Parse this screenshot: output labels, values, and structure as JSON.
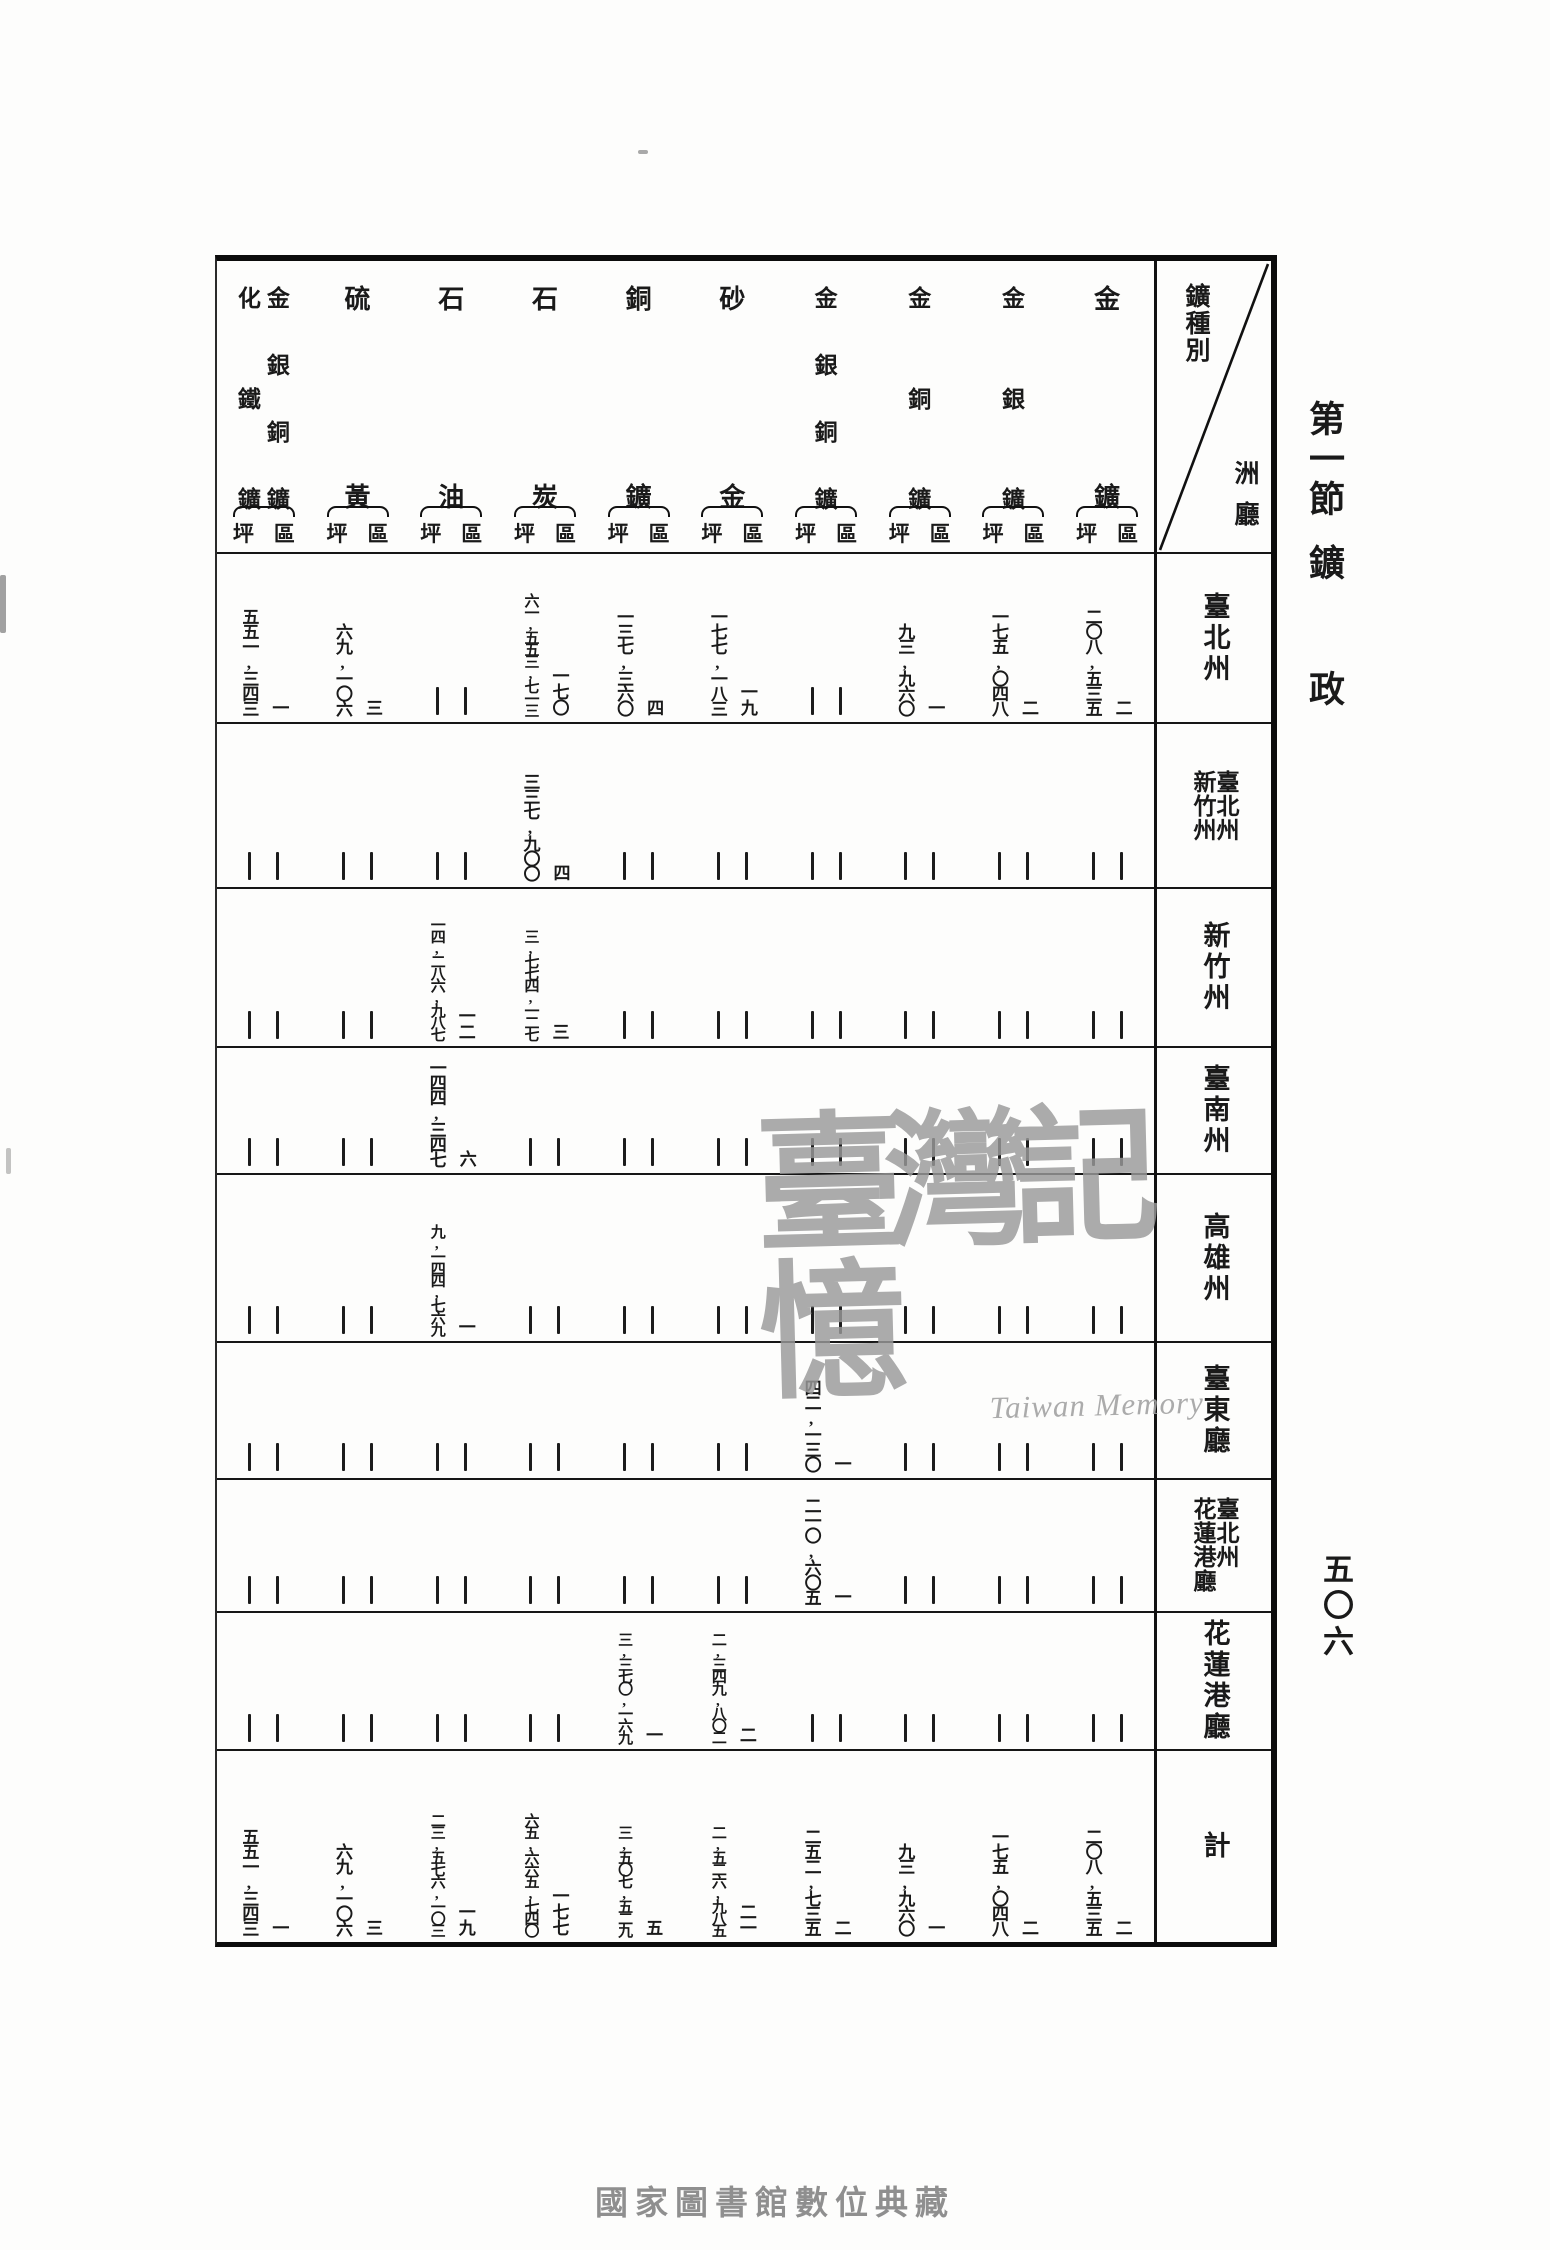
{
  "page": {
    "section_title_part1": "第一節",
    "section_title_part2": "鑛",
    "section_title_part3": "政",
    "page_number": "五〇六",
    "watermark_title": "臺灣記憶",
    "watermark_subtitle": "Taiwan Memory",
    "footer_watermark": "國家圖書館數位典藏"
  },
  "table": {
    "corner": {
      "top_label": "鑛種別",
      "bottom_label": "洲廳"
    },
    "unit_area": "坪",
    "unit_count": "區",
    "columns": [
      {
        "name_lines": [
          "金鑛"
        ]
      },
      {
        "name_lines": [
          "金銀鑛"
        ]
      },
      {
        "name_lines": [
          "金銅鑛"
        ]
      },
      {
        "name_lines": [
          "金銀銅鑛"
        ]
      },
      {
        "name_lines": [
          "砂金"
        ]
      },
      {
        "name_lines": [
          "銅鑛"
        ]
      },
      {
        "name_lines": [
          "石炭"
        ]
      },
      {
        "name_lines": [
          "石油"
        ]
      },
      {
        "name_lines": [
          "硫黃"
        ]
      },
      {
        "name_lines": [
          "金銀銅鑛",
          "化鐵鑛"
        ]
      }
    ],
    "rows": [
      {
        "label_lines": [
          "臺北州"
        ],
        "cells": [
          {
            "ku": "二",
            "tsubo": "二〇八,五三五"
          },
          {
            "ku": "二",
            "tsubo": "一七五,〇四八"
          },
          {
            "ku": "一",
            "tsubo": "九三,九六〇"
          },
          null,
          {
            "ku": "一九",
            "tsubo": "一七七,一八三"
          },
          {
            "ku": "四",
            "tsubo": "一三七,三六〇"
          },
          {
            "ku": "一七〇",
            "tsubo": "六一,五五三,七一三"
          },
          null,
          {
            "ku": "三",
            "tsubo": "六九,一〇六"
          },
          {
            "ku": "一",
            "tsubo": "五五一,三四三"
          }
        ]
      },
      {
        "label_lines": [
          "臺北州",
          "新竹州"
        ],
        "cells": [
          null,
          null,
          null,
          null,
          null,
          null,
          {
            "ku": "四",
            "tsubo": "三三七,九〇〇"
          },
          null,
          null,
          null
        ]
      },
      {
        "label_lines": [
          "新竹州"
        ],
        "cells": [
          null,
          null,
          null,
          null,
          null,
          null,
          {
            "ku": "三",
            "tsubo": "三,七七四,一二七"
          },
          {
            "ku": "一二",
            "tsubo": "一四,二八六,九八七"
          },
          null,
          null
        ]
      },
      {
        "label_lines": [
          "臺南州"
        ],
        "cells": [
          null,
          null,
          null,
          null,
          null,
          null,
          null,
          {
            "ku": "六",
            "tsubo": "一四四,三四七"
          },
          null,
          null
        ]
      },
      {
        "label_lines": [
          "高雄州"
        ],
        "cells": [
          null,
          null,
          null,
          null,
          null,
          null,
          null,
          {
            "ku": "一",
            "tsubo": "九,一四四,七六九"
          },
          null,
          null
        ]
      },
      {
        "label_lines": [
          "臺東廳"
        ],
        "cells": [
          null,
          null,
          null,
          {
            "ku": "一",
            "tsubo": "四二,一三〇"
          },
          null,
          null,
          null,
          null,
          null,
          null
        ]
      },
      {
        "label_lines": [
          "臺北州",
          "花蓮港廳"
        ],
        "cells": [
          null,
          null,
          null,
          {
            "ku": "一",
            "tsubo": "二一〇,六〇五"
          },
          null,
          null,
          null,
          null,
          null,
          null
        ]
      },
      {
        "label_lines": [
          "花蓮港廳"
        ],
        "cells": [
          null,
          null,
          null,
          null,
          {
            "ku": "二",
            "tsubo": "二,三四九,八〇二"
          },
          {
            "ku": "一",
            "tsubo": "三,三七〇,一六九"
          },
          null,
          null,
          null,
          null
        ]
      },
      {
        "label_lines": [
          "計"
        ],
        "cells": [
          {
            "ku": "二",
            "tsubo": "二〇八,五三五"
          },
          {
            "ku": "二",
            "tsubo": "一七五,〇四八"
          },
          {
            "ku": "一",
            "tsubo": "九三,九六〇"
          },
          {
            "ku": "二",
            "tsubo": "二五二,七三五"
          },
          {
            "ku": "二一",
            "tsubo": "二,五二六,九八五"
          },
          {
            "ku": "五",
            "tsubo": "三,五〇七,五二九"
          },
          {
            "ku": "一七七",
            "tsubo": "六五,六六五,七四〇"
          },
          {
            "ku": "一九",
            "tsubo": "二三,五七六,一〇三"
          },
          {
            "ku": "三",
            "tsubo": "六九,一〇六"
          },
          {
            "ku": "一",
            "tsubo": "五五一,三四三"
          }
        ]
      }
    ]
  }
}
